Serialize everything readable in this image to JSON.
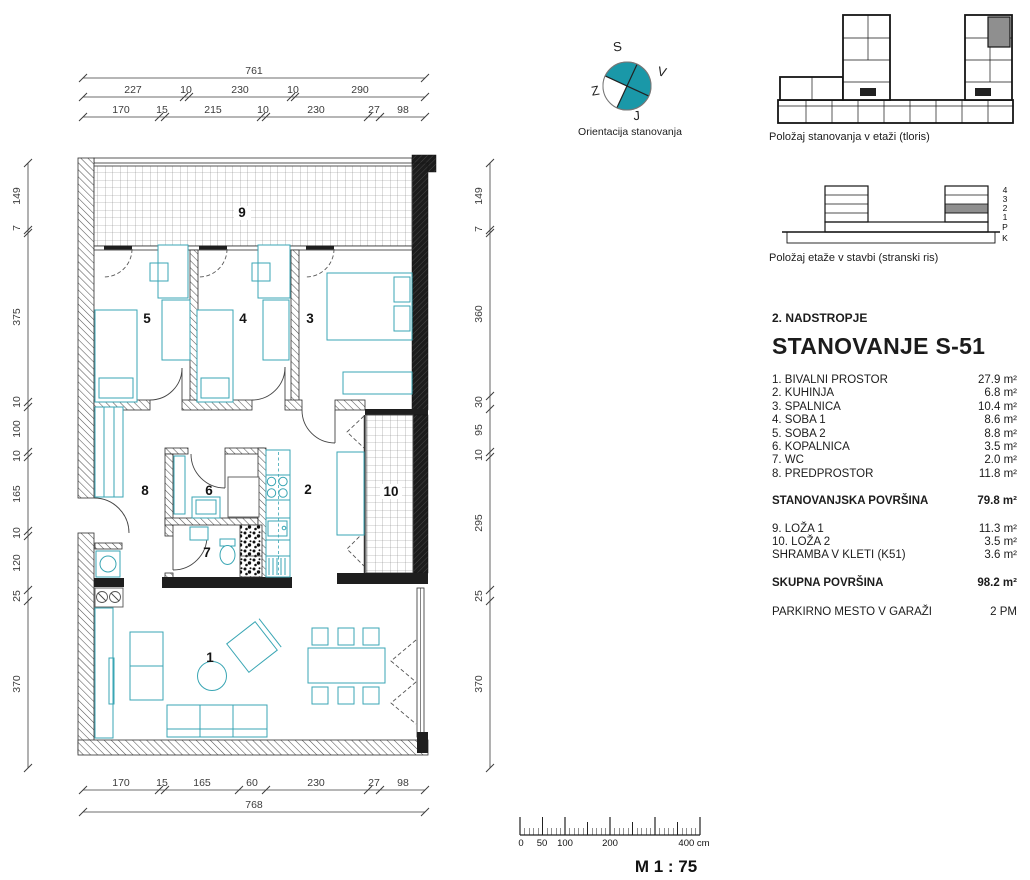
{
  "unit": {
    "floor_label": "2. NADSTROPJE",
    "title": "STANOVANJE S-51",
    "rooms": [
      {
        "num": "1",
        "name": "1. BIVALNI PROSTOR",
        "area": "27.9 m²"
      },
      {
        "num": "2",
        "name": "2. KUHINJA",
        "area": "6.8 m²"
      },
      {
        "num": "3",
        "name": "3. SPALNICA",
        "area": "10.4 m²"
      },
      {
        "num": "4",
        "name": "4. SOBA 1",
        "area": "8.6 m²"
      },
      {
        "num": "5",
        "name": "5. SOBA 2",
        "area": "8.8 m²"
      },
      {
        "num": "6",
        "name": "6. KOPALNICA",
        "area": "3.5 m²"
      },
      {
        "num": "7",
        "name": "7. WC",
        "area": "2.0 m²"
      },
      {
        "num": "8",
        "name": "8. PREDPROSTOR",
        "area": "11.8 m²"
      }
    ],
    "living_total_label": "STANOVANJSKA POVRŠINA",
    "living_total": "79.8 m²",
    "extras": [
      {
        "num": "9",
        "name": "9. LOŽA 1",
        "area": "11.3 m²"
      },
      {
        "num": "10",
        "name": "10. LOŽA 2",
        "area": "3.5 m²"
      },
      {
        "num": "",
        "name": "SHRAMBA V KLETI (K51)",
        "area": "3.6 m²"
      }
    ],
    "grand_total_label": "SKUPNA POVRŠINA",
    "grand_total": "98.2 m²",
    "parking_label": "PARKIRNO MESTO V GARAŽI",
    "parking": "2 PM"
  },
  "dims": {
    "top1": [
      "761"
    ],
    "top2": [
      "227",
      "10",
      "230",
      "10",
      "290"
    ],
    "top3": [
      "170",
      "15",
      "215",
      "10",
      "230",
      "27",
      "98"
    ],
    "left": [
      "149",
      "7",
      "375",
      "10",
      "100",
      "10",
      "165",
      "10",
      "120",
      "25",
      "370"
    ],
    "right": [
      "149",
      "7",
      "360",
      "30",
      "95",
      "10",
      "295",
      "25",
      "370"
    ],
    "bottom1": [
      "170",
      "15",
      "165",
      "60",
      "230",
      "27",
      "98"
    ],
    "bottom2": [
      "768"
    ]
  },
  "compass": {
    "north": "S",
    "east": "V",
    "west": "Z",
    "south": "J",
    "caption": "Orientacija stanovanja"
  },
  "diagrams": {
    "floor_plan_caption": "Položaj stanovanja v etaži (tloris)",
    "elevation_caption": "Položaj etaže v stavbi (stranski ris)",
    "levels": [
      "4",
      "3",
      "2",
      "1",
      "P",
      "K"
    ]
  },
  "scalebar": {
    "ticks": [
      "0",
      "50",
      "100",
      "200",
      "400 cm"
    ],
    "scale_label": "M 1 : 75"
  },
  "colors": {
    "accent_teal": "#3aa6b4",
    "compass_teal": "#1a98a8",
    "highlight_gray": "#8f8f8f"
  }
}
